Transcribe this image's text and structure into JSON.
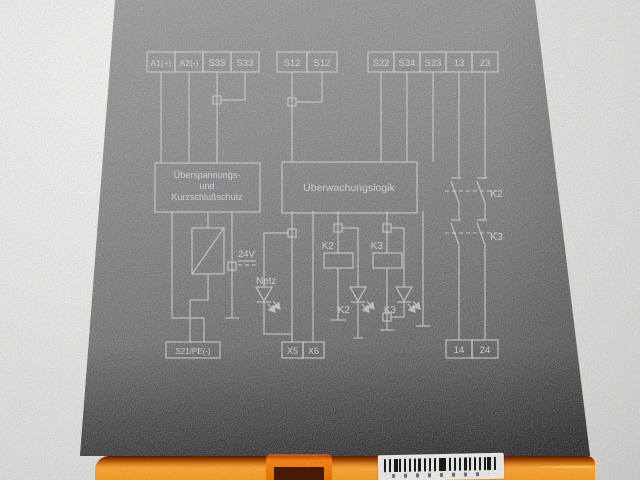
{
  "terminals": {
    "top_left": [
      "A1(+)",
      "A2(-)",
      "S33",
      "S33"
    ],
    "top_mid": [
      "S12",
      "S12"
    ],
    "top_right": [
      "S22",
      "S34",
      "S23",
      "13",
      "23"
    ],
    "bottom_left": "S21/PE(-)",
    "bottom_mid": [
      "X5",
      "X6"
    ],
    "bottom_right": [
      "14",
      "24"
    ]
  },
  "blocks": {
    "protection": [
      "Überspannungs-",
      "und",
      "Kurzschlußschutz"
    ],
    "logic": "Überwachungslogik"
  },
  "labels": {
    "voltage": "24V",
    "power_led": "Netz",
    "coil_k2": "K2",
    "coil_k3": "K3",
    "led_k2": "K2",
    "led_k3": "K3",
    "contact_k2": "K2",
    "contact_k3": "K3"
  },
  "colors": {
    "housing_gray": "#737478",
    "print_ink": "#d2d0c6",
    "base_orange": "#ff9526",
    "base_red_edge": "#a82500",
    "barcode_label": "#f3f2ee",
    "background": "#f1f0ed"
  }
}
